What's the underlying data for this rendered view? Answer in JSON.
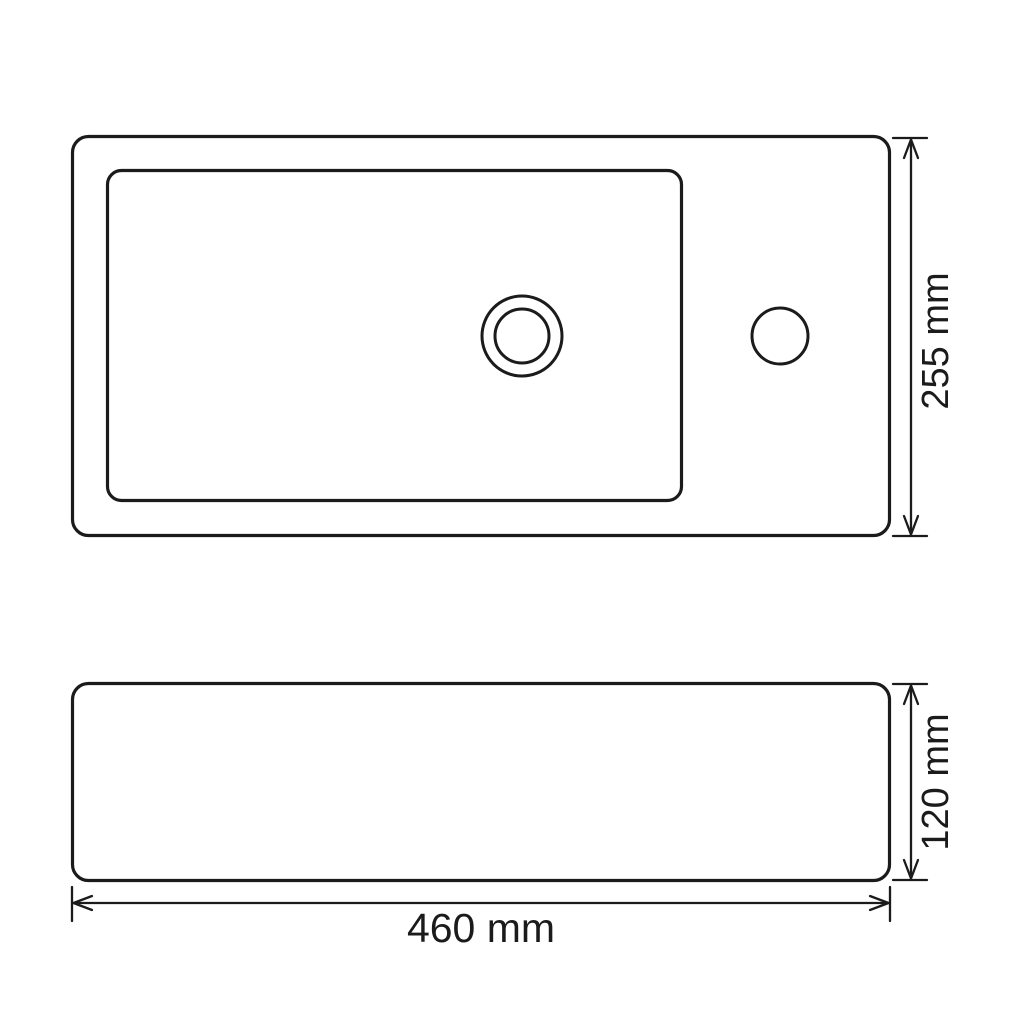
{
  "canvas": {
    "background_color": "#ffffff",
    "line_color": "#1b1b1b",
    "text_color": "#1b1b1b"
  },
  "drawing": {
    "views": {
      "top": {
        "name": "top-view"
      },
      "front": {
        "name": "front-view"
      }
    },
    "dimensions": {
      "depth": {
        "label": "255 mm",
        "value": 255,
        "unit": "mm"
      },
      "height": {
        "label": "120 mm",
        "value": 120,
        "unit": "mm"
      },
      "width": {
        "label": "460 mm",
        "value": 460,
        "unit": "mm"
      }
    }
  }
}
